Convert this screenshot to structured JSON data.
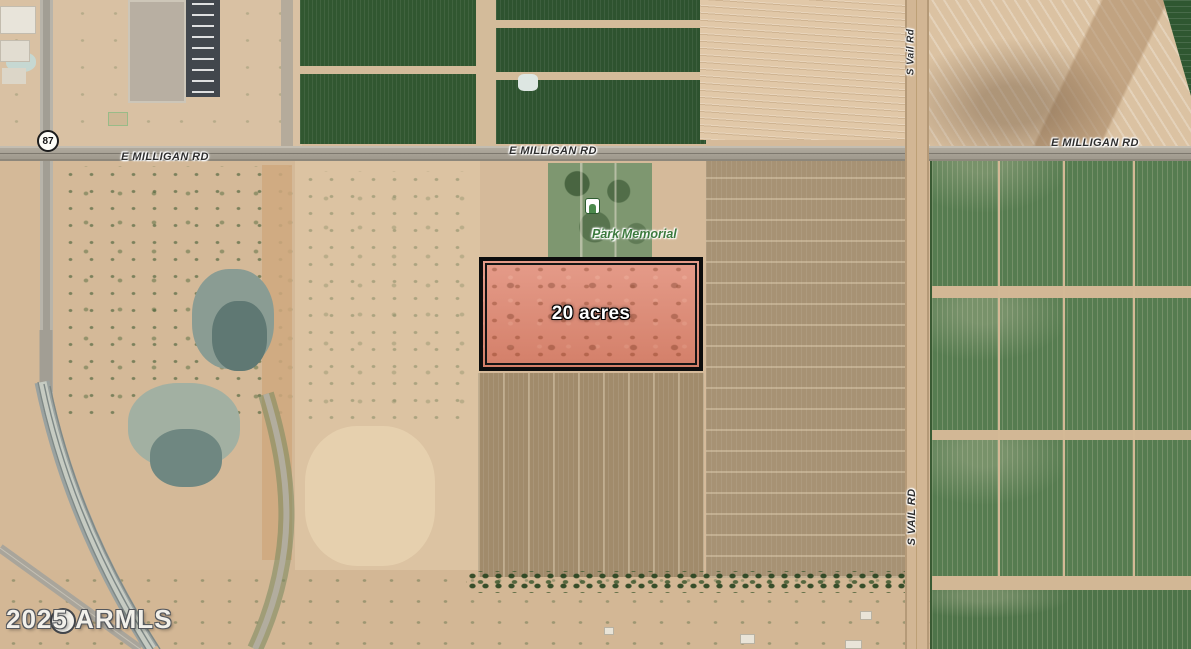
{
  "parcel": {
    "label": "20 acres"
  },
  "road_labels": {
    "milligan_left": "E MILLIGAN RD",
    "milligan_center": "E MILLIGAN RD",
    "milligan_right": "E MILLIGAN RD",
    "vail_upper": "S Vail Rd",
    "vail_lower": "S VAIL RD"
  },
  "highway_shield": {
    "route_number": "87"
  },
  "park_label": {
    "line1": "Eloy Memorial",
    "line2": "Park"
  },
  "watermark": {
    "text": "2025 ARMLS"
  },
  "colors": {
    "parcel_fill": "#e2907c",
    "parcel_border": "#0d0d0d",
    "park_text_green": "#3c7a3e",
    "road_label_text": "#2e2e2e",
    "crop_dark_green": "#2e532f",
    "field_green": "#567c50",
    "field_brown": "#a18b6b",
    "desert_tan": "#d5ba9a",
    "road_gray": "#a29e94"
  }
}
